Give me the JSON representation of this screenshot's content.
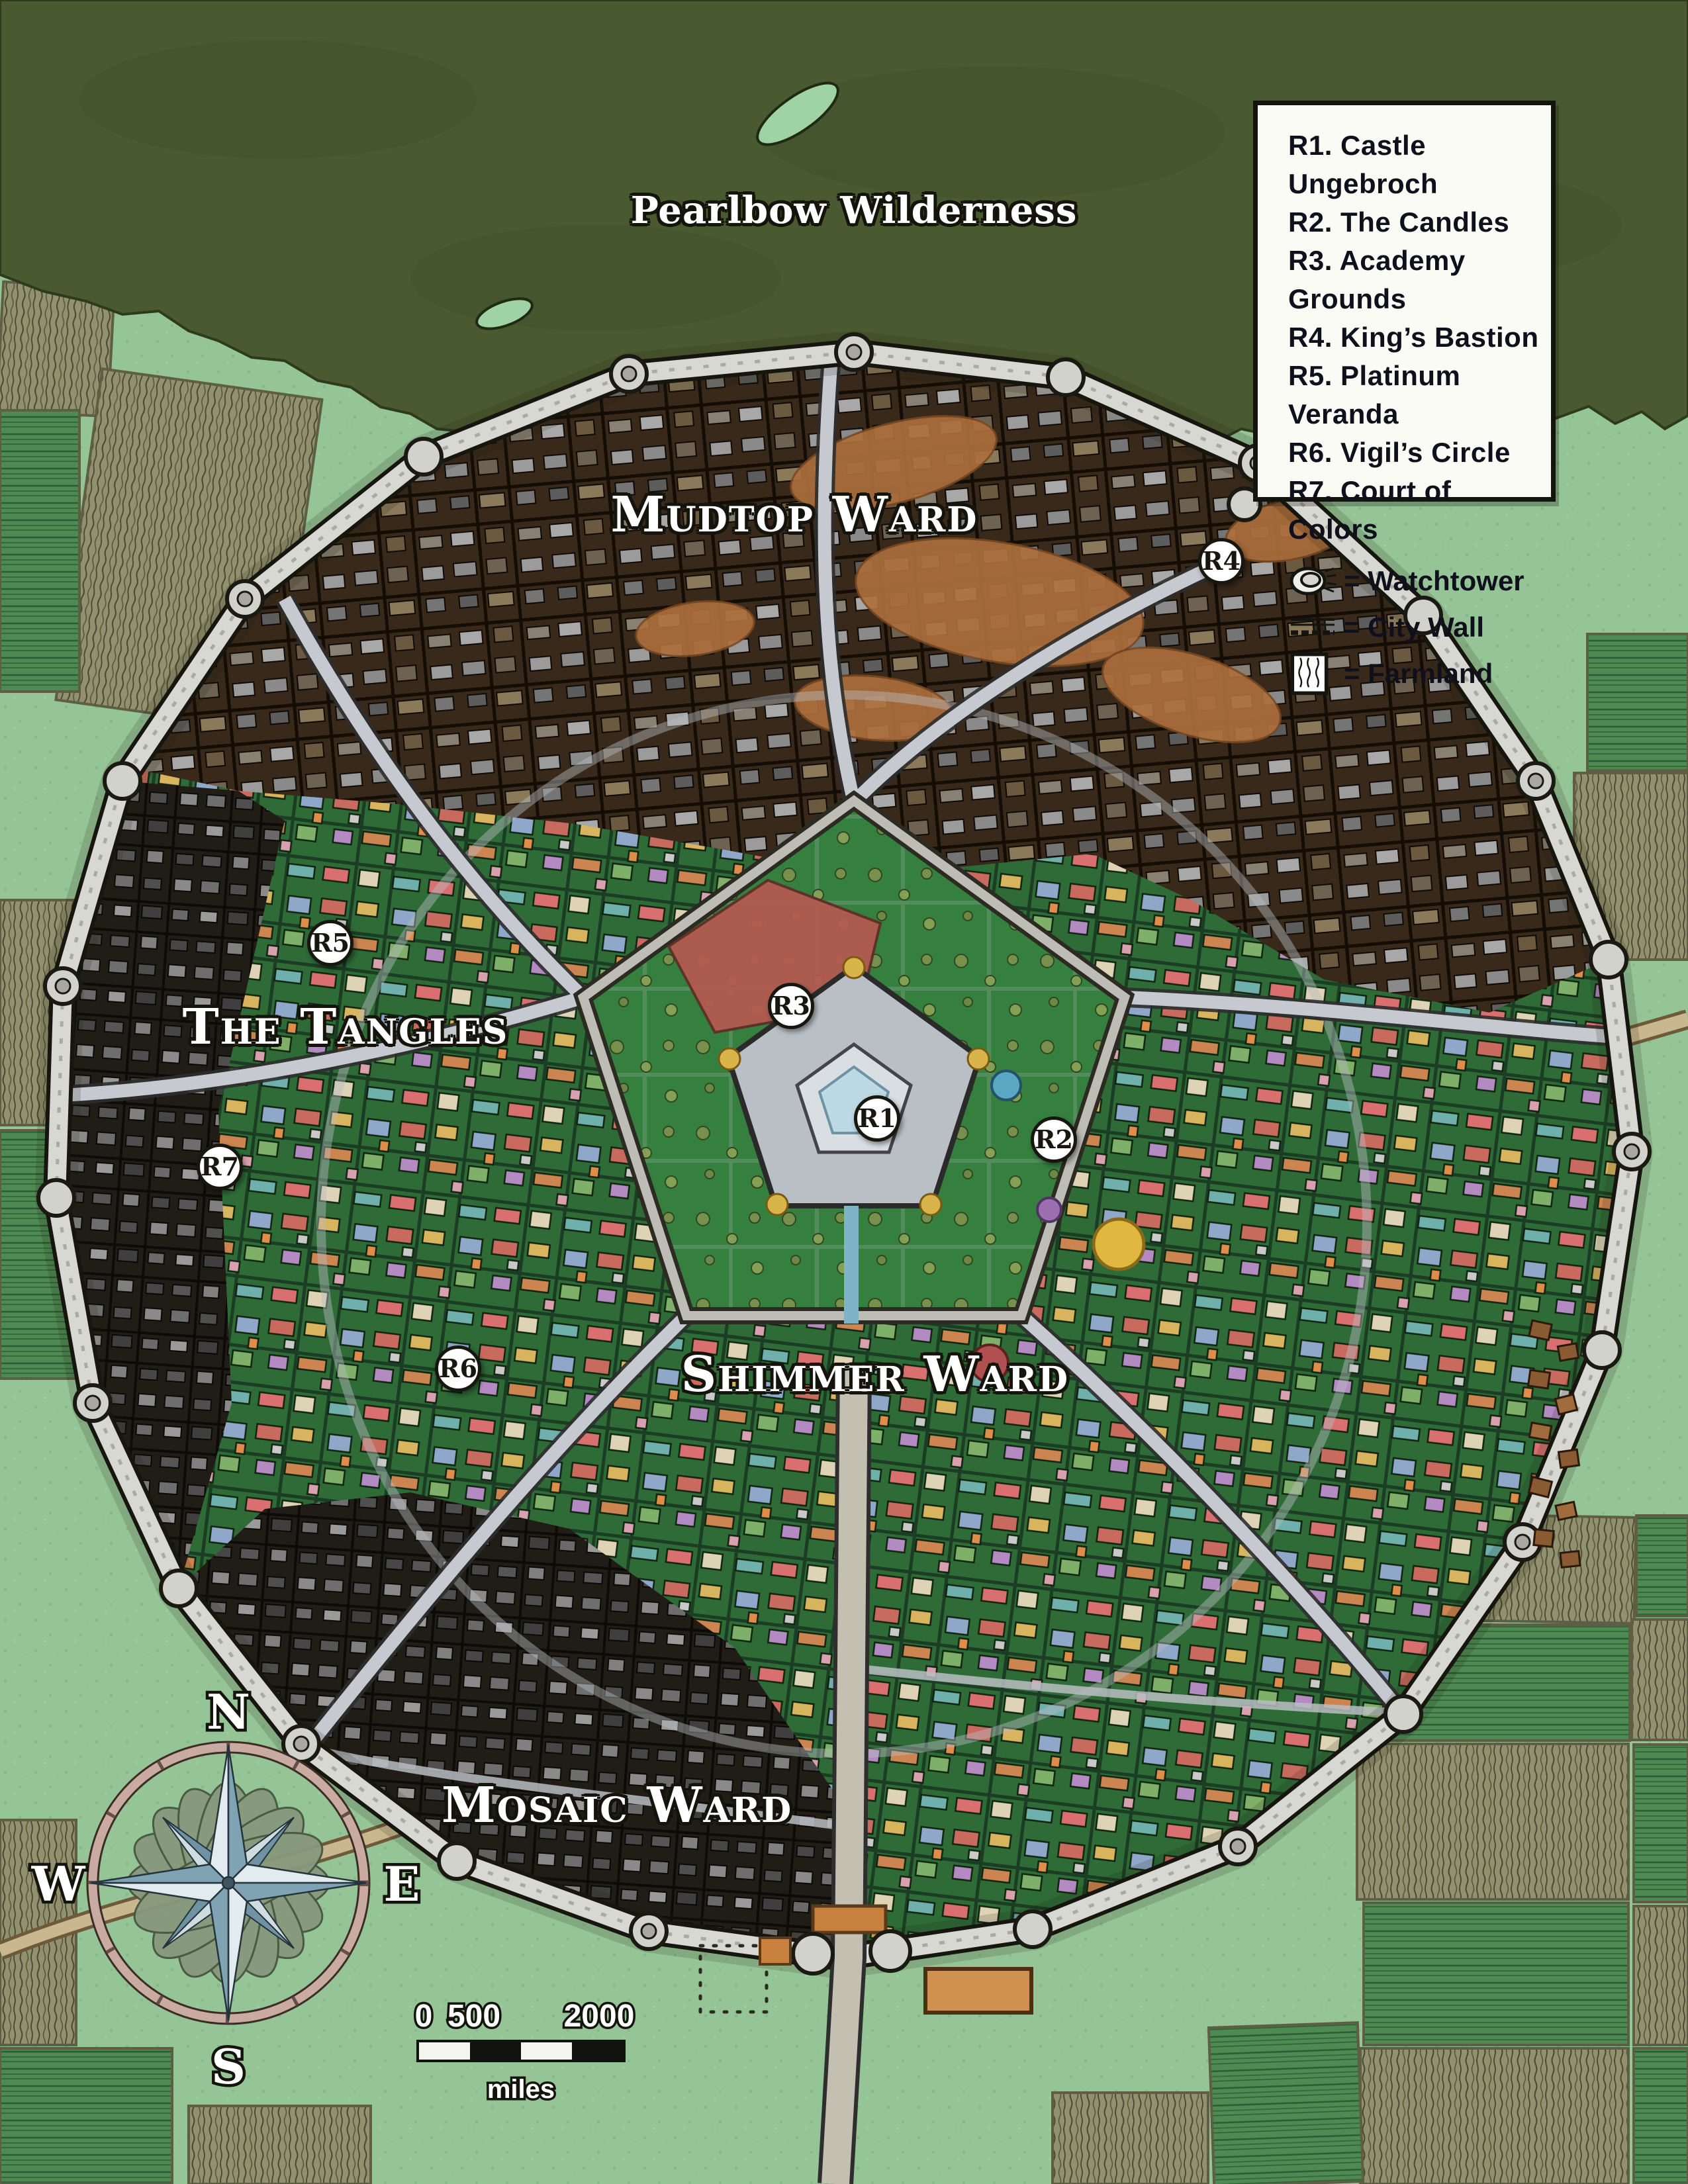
{
  "labels": {
    "wilderness": {
      "text": "Pearlbow Wilderness",
      "x": 50.59,
      "y": 9.64
    },
    "wards": [
      {
        "text": "Mudtop Ward",
        "x": 47.06,
        "y": 23.58
      },
      {
        "text": "The Tangles",
        "x": 20.47,
        "y": 47.03
      },
      {
        "text": "Shimmer Ward",
        "x": 51.84,
        "y": 62.94
      },
      {
        "text": "Mosaic Ward",
        "x": 36.55,
        "y": 82.67
      }
    ]
  },
  "legend": {
    "entries": [
      {
        "label": "R1. Castle Ungebroch"
      },
      {
        "label": "R2. The Candles"
      },
      {
        "label": "R3. Academy Grounds"
      },
      {
        "label": "R4. King’s Bastion"
      },
      {
        "label": "R5. Platinum Veranda"
      },
      {
        "label": "R6. Vigil’s Circle"
      },
      {
        "label": "R7. Court of Colors"
      }
    ],
    "symbols": [
      {
        "icon": "watchtower-icon",
        "label": "= Watchtower"
      },
      {
        "icon": "city-wall-icon",
        "label": "= City Wall"
      },
      {
        "icon": "farmland-icon",
        "label": "= Farmland"
      }
    ]
  },
  "markers": [
    {
      "id": "R1",
      "x": 51.96,
      "y": 51.21
    },
    {
      "id": "R2",
      "x": 62.43,
      "y": 52.18
    },
    {
      "id": "R3",
      "x": 46.86,
      "y": 46.06
    },
    {
      "id": "R4",
      "x": 72.35,
      "y": 25.7
    },
    {
      "id": "R5",
      "x": 19.57,
      "y": 43.18
    },
    {
      "id": "R6",
      "x": 27.14,
      "y": 62.67
    },
    {
      "id": "R7",
      "x": 13.02,
      "y": 53.42
    }
  ],
  "compass": {
    "north": "N",
    "east": "E",
    "south": "S",
    "west": "W"
  },
  "scale_bar": {
    "tick_start": "0",
    "tick_mid": "500",
    "tick_end": "2000",
    "unit": "miles"
  },
  "palette": {
    "forest": "#4a5a30",
    "grass": "#95c497",
    "city_wall_light": "#d8d8d2",
    "mud": "#ad6f3c",
    "district_green": "#2e6b37",
    "mosaic_dark": "#201d16",
    "farm_olive": "#91916f",
    "farm_green": "#4f8a53",
    "marker_bg": "#fefefe",
    "compass_star_dark": "#7fa3b2",
    "compass_star_light": "#e2ebee",
    "academy_red": "#b25b50",
    "road_light": "#c6cad0",
    "path_tan": "#c9b78f"
  }
}
